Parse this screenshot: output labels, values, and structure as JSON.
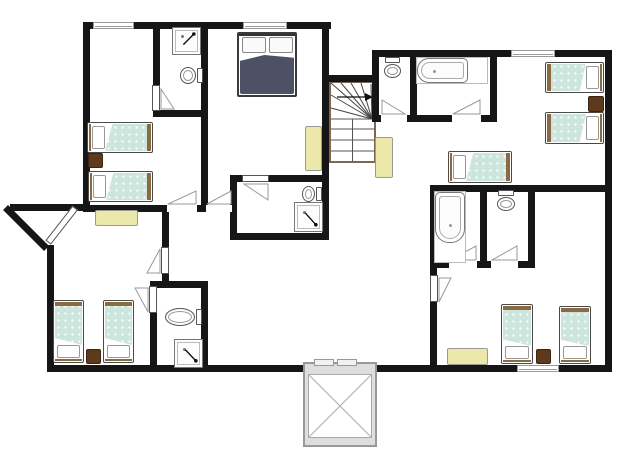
{
  "meta": {
    "kind": "floor-plan",
    "width": 622,
    "height": 467
  },
  "palette": {
    "wall": "#161616",
    "line": "#999999",
    "window_frame": "#9a9a9a",
    "bed_teal": "#cde6dd",
    "bed_frame_brown": "#8a6a42",
    "bed_outline": "#4a4a4a",
    "duvet_dark": "#4d5166",
    "table_yellow": "#ece8a9",
    "nightstand_brown": "#5e3a1d",
    "fixture_outline": "#666666",
    "stair_brown": "#7d6750",
    "elevator_gray": "#dedede"
  },
  "walls": [
    [
      83,
      22,
      248,
      7
    ],
    [
      83,
      22,
      7,
      190
    ],
    [
      10,
      204,
      80,
      7
    ],
    [
      47,
      245,
      7,
      127
    ],
    [
      47,
      365,
      565,
      7
    ],
    [
      605,
      50,
      7,
      322
    ],
    [
      372,
      50,
      240,
      7
    ],
    [
      372,
      50,
      7,
      32
    ],
    [
      322,
      75,
      57,
      7
    ],
    [
      322,
      22,
      7,
      218
    ],
    [
      372,
      75,
      7,
      47
    ],
    [
      153,
      22,
      7,
      66
    ],
    [
      153,
      110,
      54,
      7
    ],
    [
      201,
      22,
      7,
      190
    ],
    [
      83,
      205,
      152,
      7
    ],
    [
      230,
      175,
      7,
      65
    ],
    [
      230,
      175,
      99,
      7
    ],
    [
      230,
      233,
      99,
      7
    ],
    [
      162,
      205,
      7,
      45
    ],
    [
      162,
      270,
      7,
      15
    ],
    [
      150,
      281,
      58,
      7
    ],
    [
      150,
      281,
      7,
      91
    ],
    [
      201,
      281,
      7,
      91
    ],
    [
      410,
      57,
      7,
      65
    ],
    [
      490,
      57,
      7,
      65
    ],
    [
      372,
      115,
      125,
      7
    ],
    [
      430,
      185,
      182,
      7
    ],
    [
      430,
      185,
      7,
      187
    ],
    [
      480,
      185,
      7,
      83
    ],
    [
      528,
      185,
      7,
      83
    ],
    [
      430,
      261,
      105,
      7
    ]
  ],
  "diag_walls": [
    {
      "x": 8,
      "y": 205,
      "len": 58,
      "angle": 45,
      "th": 7
    }
  ],
  "windows": [
    [
      93,
      22,
      41,
      7
    ],
    [
      243,
      22,
      44,
      7
    ],
    [
      511,
      50,
      44,
      7
    ],
    [
      517,
      365,
      42,
      7
    ]
  ],
  "door_openings": [
    [
      167,
      205,
      30,
      7
    ],
    [
      206,
      205,
      26,
      7
    ],
    [
      242,
      175,
      27,
      7
    ],
    [
      381,
      115,
      26,
      7
    ],
    [
      452,
      115,
      29,
      7
    ],
    [
      449,
      261,
      28,
      7
    ],
    [
      491,
      261,
      27,
      7
    ]
  ],
  "door_leaves": [
    [
      152,
      85,
      8,
      26
    ],
    [
      161,
      247,
      8,
      27
    ],
    [
      149,
      286,
      8,
      27
    ],
    [
      430,
      275,
      8,
      27
    ],
    [
      242,
      175,
      27,
      7
    ],
    [
      78,
      210,
      44,
      7,
      128
    ]
  ],
  "door_swings": [
    {
      "r": [
        160,
        88,
        15,
        22
      ],
      "c": "bl"
    },
    {
      "r": [
        167,
        190,
        30,
        15
      ],
      "c": "br"
    },
    {
      "r": [
        206,
        190,
        26,
        15
      ],
      "c": "br"
    },
    {
      "r": [
        243,
        183,
        26,
        18
      ],
      "c": "tr"
    },
    {
      "r": [
        146,
        248,
        15,
        26
      ],
      "c": "br"
    },
    {
      "r": [
        134,
        287,
        15,
        26
      ],
      "c": "tr"
    },
    {
      "r": [
        381,
        99,
        25,
        16
      ],
      "c": "bl"
    },
    {
      "r": [
        452,
        99,
        29,
        16
      ],
      "c": "br"
    },
    {
      "r": [
        438,
        277,
        14,
        26
      ],
      "c": "tl"
    },
    {
      "r": [
        449,
        245,
        28,
        16
      ],
      "c": "br"
    },
    {
      "r": [
        491,
        245,
        27,
        16
      ],
      "c": "br"
    }
  ],
  "single_beds": [
    {
      "r": [
        87,
        122,
        66,
        31
      ],
      "head": "left"
    },
    {
      "r": [
        88,
        171,
        65,
        31
      ],
      "head": "left"
    },
    {
      "r": [
        53,
        300,
        31,
        63
      ],
      "head": "bottom"
    },
    {
      "r": [
        103,
        300,
        31,
        63
      ],
      "head": "bottom"
    },
    {
      "r": [
        545,
        62,
        59,
        31
      ],
      "head": "right"
    },
    {
      "r": [
        545,
        112,
        59,
        32
      ],
      "head": "right"
    },
    {
      "r": [
        448,
        151,
        64,
        32
      ],
      "head": "left"
    },
    {
      "r": [
        501,
        304,
        32,
        60
      ],
      "head": "bottom"
    },
    {
      "r": [
        559,
        306,
        32,
        58
      ],
      "head": "bottom"
    }
  ],
  "double_bed": {
    "r": [
      237,
      32,
      60,
      65
    ]
  },
  "nightstands": [
    [
      88,
      153,
      15,
      15
    ],
    [
      588,
      96,
      16,
      16
    ],
    [
      536,
      349,
      15,
      15
    ],
    [
      86,
      349,
      15,
      15
    ]
  ],
  "tables": [
    [
      95,
      210,
      43,
      16
    ],
    [
      305,
      126,
      17,
      45
    ],
    [
      375,
      137,
      18,
      41
    ],
    [
      447,
      348,
      41,
      17
    ]
  ],
  "toilets": [
    {
      "r": [
        179,
        67,
        24,
        17
      ],
      "facing": "left"
    },
    {
      "r": [
        384,
        57,
        17,
        22
      ],
      "facing": "down"
    },
    {
      "r": [
        301,
        186,
        21,
        16
      ],
      "facing": "left"
    },
    {
      "r": [
        497,
        190,
        18,
        22
      ],
      "facing": "down"
    },
    {
      "r": [
        164,
        308,
        38,
        18
      ],
      "facing": "left"
    }
  ],
  "showers": [
    {
      "r": [
        172,
        27,
        29,
        28
      ],
      "arrow": "tr"
    },
    {
      "r": [
        294,
        202,
        29,
        30
      ],
      "arrow": "br"
    },
    {
      "r": [
        174,
        339,
        29,
        29
      ],
      "arrow": "br"
    }
  ],
  "tubs": [
    {
      "alcove": [
        416,
        57,
        72,
        27
      ],
      "tub": [
        417,
        58,
        51,
        25
      ],
      "bulge": "left"
    },
    {
      "alcove": [
        434,
        191,
        32,
        72
      ],
      "tub": [
        435,
        192,
        30,
        51
      ],
      "bulge": "bottom"
    }
  ],
  "stairs": {
    "box": [
      329,
      81,
      47,
      82
    ]
  },
  "elevator": {
    "outer": [
      303,
      362,
      74,
      85
    ],
    "inner": [
      308,
      374,
      64,
      64
    ],
    "doors": [
      [
        314,
        359,
        20,
        7
      ],
      [
        337,
        359,
        20,
        7
      ]
    ]
  }
}
